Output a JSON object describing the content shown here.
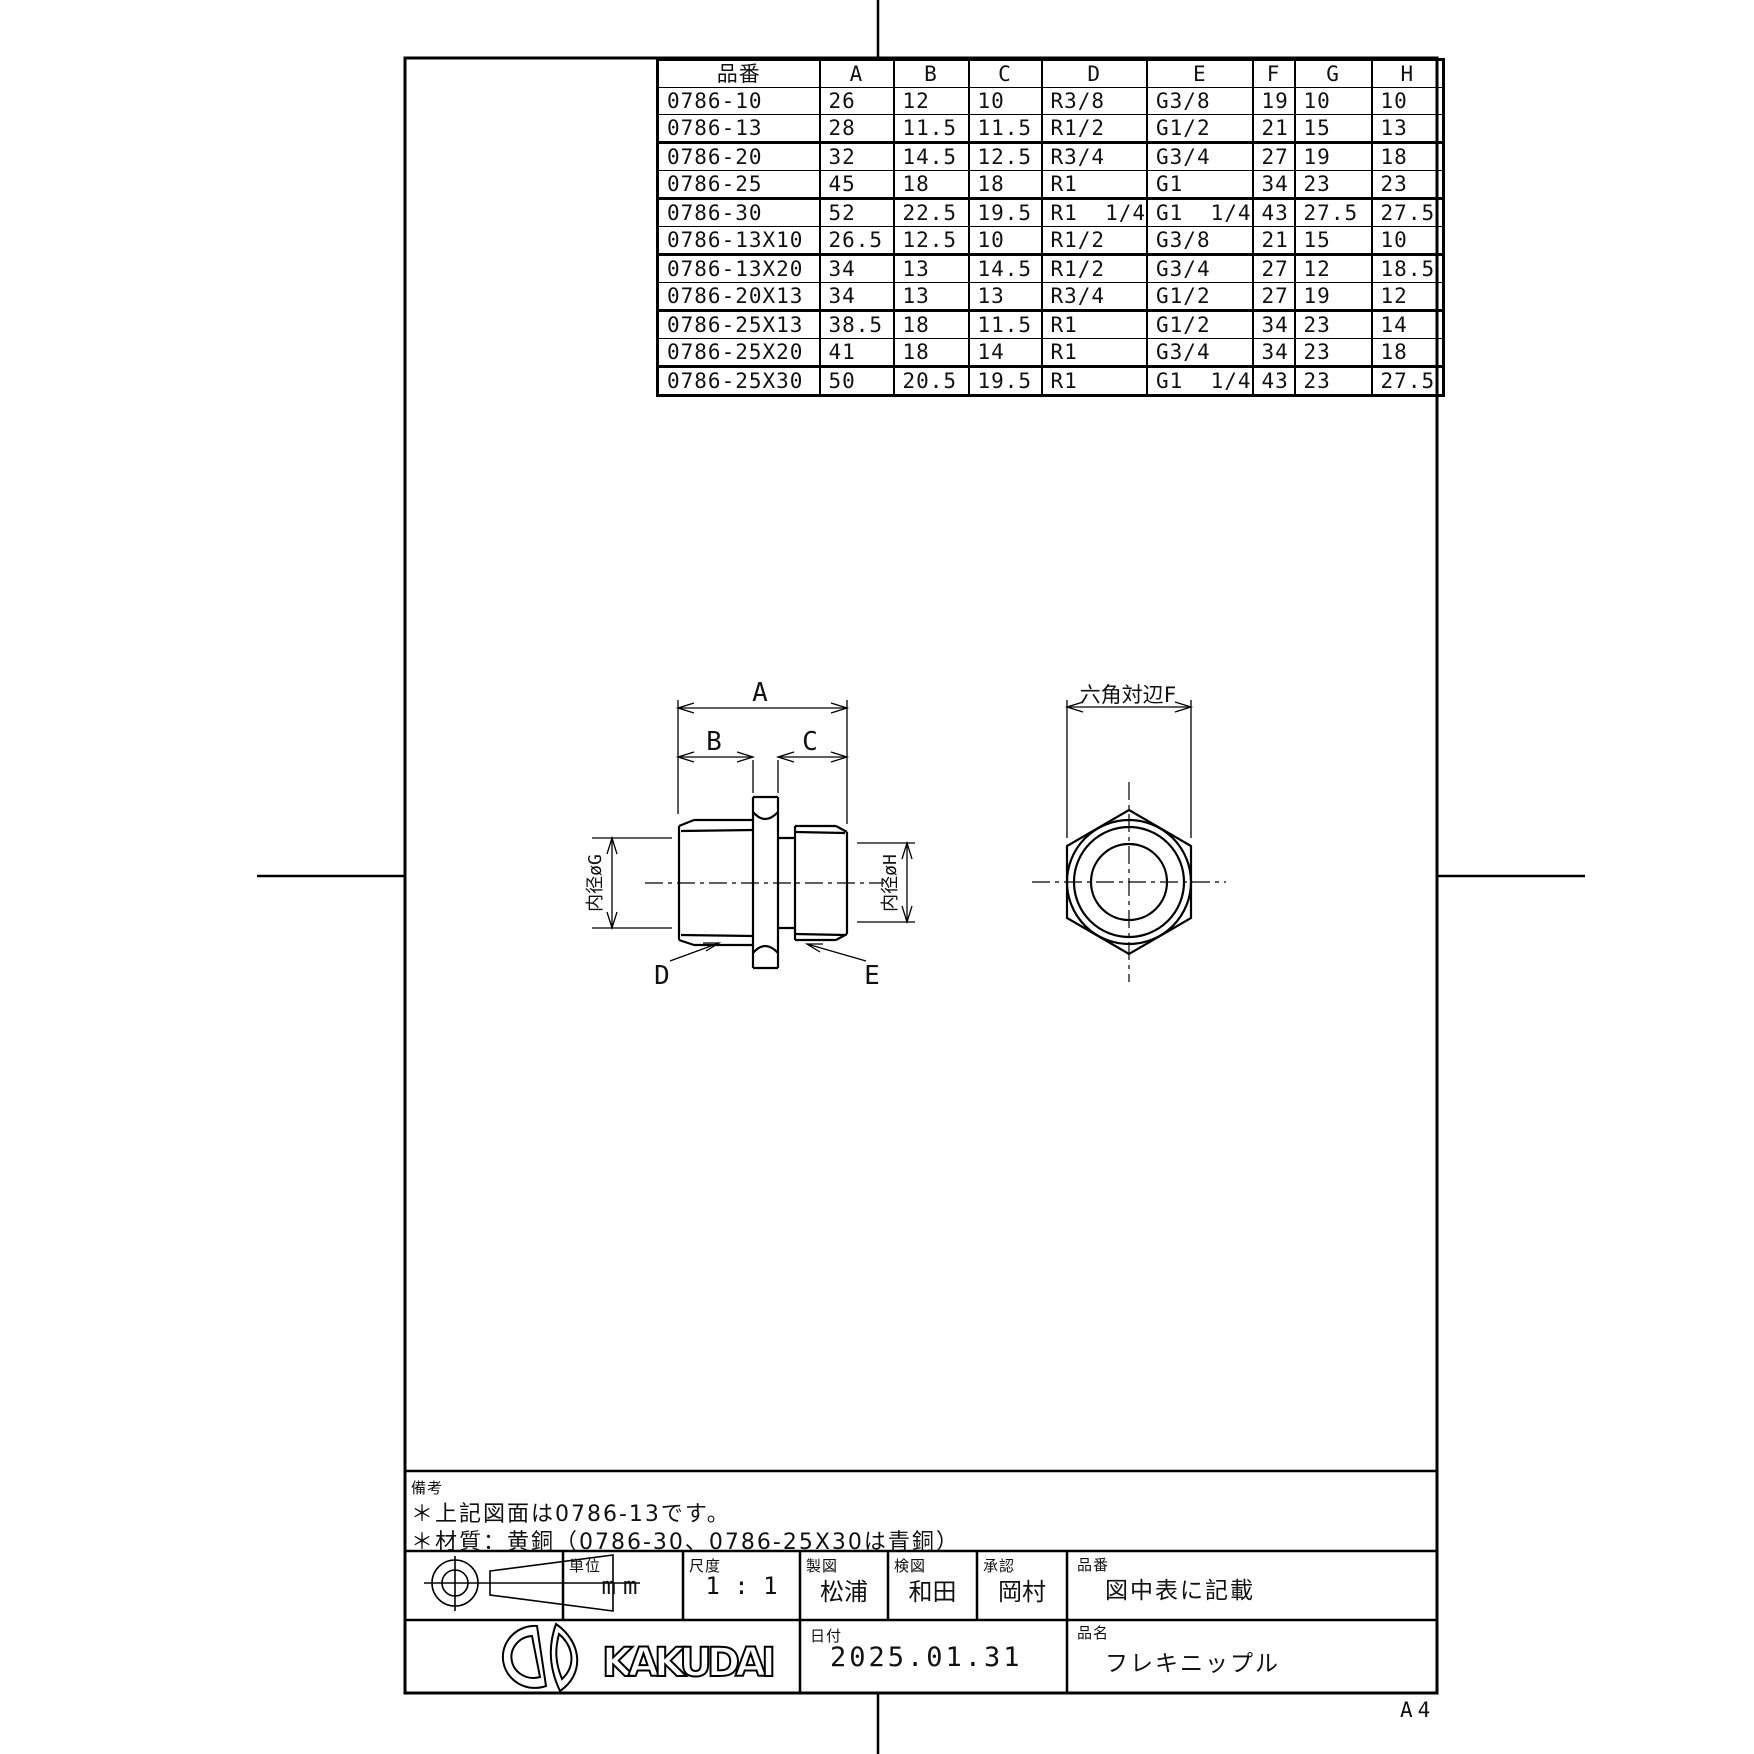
{
  "sheet": {
    "size_label": "A4"
  },
  "table": {
    "headers": [
      "品番",
      "A",
      "B",
      "C",
      "D",
      "E",
      "F",
      "G",
      "H"
    ],
    "rows": [
      [
        "0786-10",
        "26",
        "12",
        "10",
        "R3/8",
        "G3/8",
        "19",
        "10",
        "10"
      ],
      [
        "0786-13",
        "28",
        "11.5",
        "11.5",
        "R1/2",
        "G1/2",
        "21",
        "15",
        "13"
      ],
      [
        "0786-20",
        "32",
        "14.5",
        "12.5",
        "R3/4",
        "G3/4",
        "27",
        "19",
        "18"
      ],
      [
        "0786-25",
        "45",
        "18",
        "18",
        "R1",
        "G1",
        "34",
        "23",
        "23"
      ],
      [
        "0786-30",
        "52",
        "22.5",
        "19.5",
        "R1  1/4",
        "G1  1/4",
        "43",
        "27.5",
        "27.5"
      ],
      [
        "0786-13X10",
        "26.5",
        "12.5",
        "10",
        "R1/2",
        "G3/8",
        "21",
        "15",
        "10"
      ],
      [
        "0786-13X20",
        "34",
        "13",
        "14.5",
        "R1/2",
        "G3/4",
        "27",
        "12",
        "18.5"
      ],
      [
        "0786-20X13",
        "34",
        "13",
        "13",
        "R3/4",
        "G1/2",
        "27",
        "19",
        "12"
      ],
      [
        "0786-25X13",
        "38.5",
        "18",
        "11.5",
        "R1",
        "G1/2",
        "34",
        "23",
        "14"
      ],
      [
        "0786-25X20",
        "41",
        "18",
        "14",
        "R1",
        "G3/4",
        "34",
        "23",
        "18"
      ],
      [
        "0786-25X30",
        "50",
        "20.5",
        "19.5",
        "R1",
        "G1  1/4",
        "43",
        "23",
        "27.5"
      ]
    ]
  },
  "drawing": {
    "dim_a": "A",
    "dim_b": "B",
    "dim_c": "C",
    "label_d": "D",
    "label_e": "E",
    "dim_inner_g": "内径øG",
    "dim_inner_h": "内径øH",
    "hex_dim": "六角対辺F"
  },
  "notes": {
    "title": "備考",
    "line1": "＊上記図面は0786-13です。",
    "line2": "＊材質：黄銅（0786-30、0786-25X30は青銅）"
  },
  "title_block": {
    "unit_label": "単位",
    "unit_value": "mm",
    "scale_label": "尺度",
    "scale_value": "1 : 1",
    "drafter_label": "製図",
    "drafter_value": "松浦",
    "checker_label": "検図",
    "checker_value": "和田",
    "approver_label": "承認",
    "approver_value": "岡村",
    "part_no_label": "品番",
    "part_no_value": "図中表に記載",
    "date_label": "日付",
    "date_value": "2025.01.31",
    "name_label": "品名",
    "name_value": "フレキニップル",
    "brand": "KAKUDAI"
  }
}
